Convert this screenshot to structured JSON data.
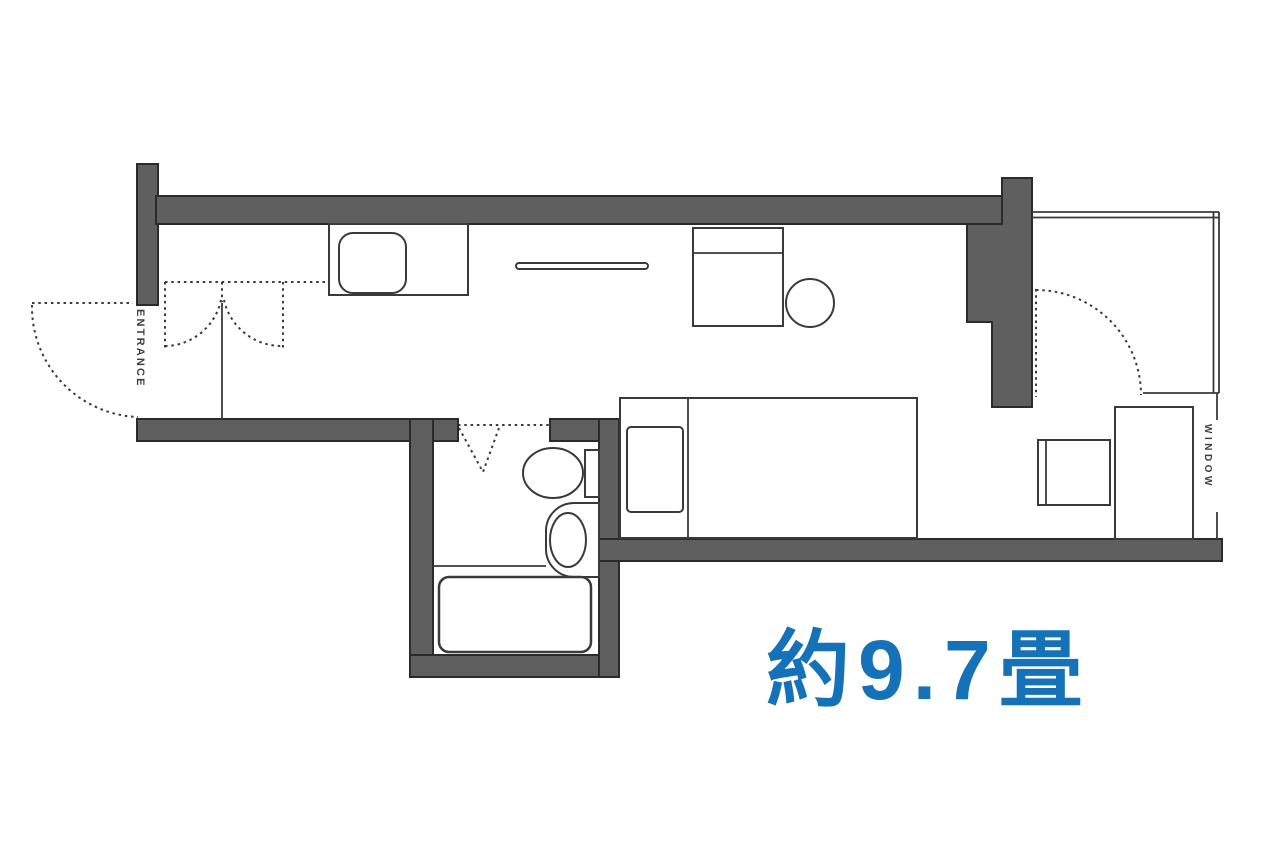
{
  "floorplan": {
    "labels": {
      "entrance": "ENTRANCE",
      "window": "WINDOW",
      "area": "約9.7畳"
    },
    "colors": {
      "background": "#ffffff",
      "wall_fill": "#5f5f5f",
      "wall_outline": "#2b2b2b",
      "line": "#3a3a3a",
      "label_text": "#3d3d3d",
      "area_text": "#1572b9"
    },
    "features": [
      "entrance-door-swing",
      "closet-double-doors",
      "kitchen-counter",
      "kitchen-sink",
      "hanger-rod",
      "desk",
      "desk-chair",
      "bed",
      "pillow",
      "bathroom-folding-door",
      "toilet",
      "washbasin",
      "bathtub",
      "balcony-door-swing",
      "window-bay",
      "window-desk",
      "window-chair"
    ]
  }
}
